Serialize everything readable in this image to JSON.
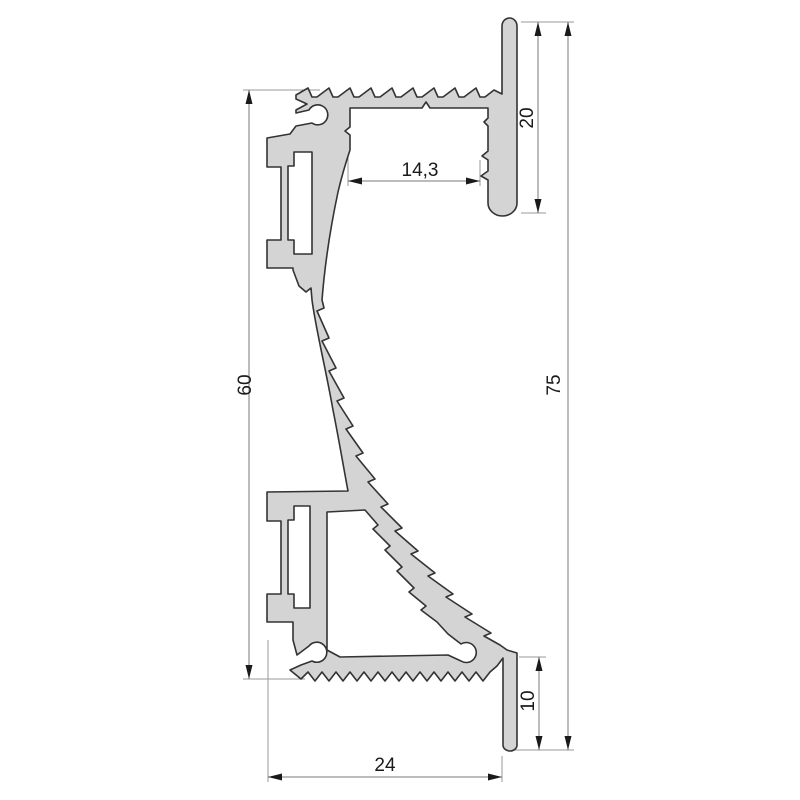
{
  "drawing": {
    "type": "technical-cross-section",
    "subject": "aluminium wall profile cross-section",
    "background": "#ffffff",
    "profile_fill": "#d4d4d4",
    "profile_stroke": "#333333",
    "dimension_color": "#1a1a1a",
    "dimensions": {
      "fin_top_height": {
        "label": "20",
        "orientation": "vertical"
      },
      "channel_width": {
        "label": "14,3",
        "orientation": "horizontal"
      },
      "body_height": {
        "label": "60",
        "orientation": "vertical"
      },
      "overall_height": {
        "label": "75",
        "orientation": "vertical"
      },
      "fin_bottom_height": {
        "label": "10",
        "orientation": "vertical"
      },
      "base_width": {
        "label": "24",
        "orientation": "horizontal"
      }
    }
  }
}
